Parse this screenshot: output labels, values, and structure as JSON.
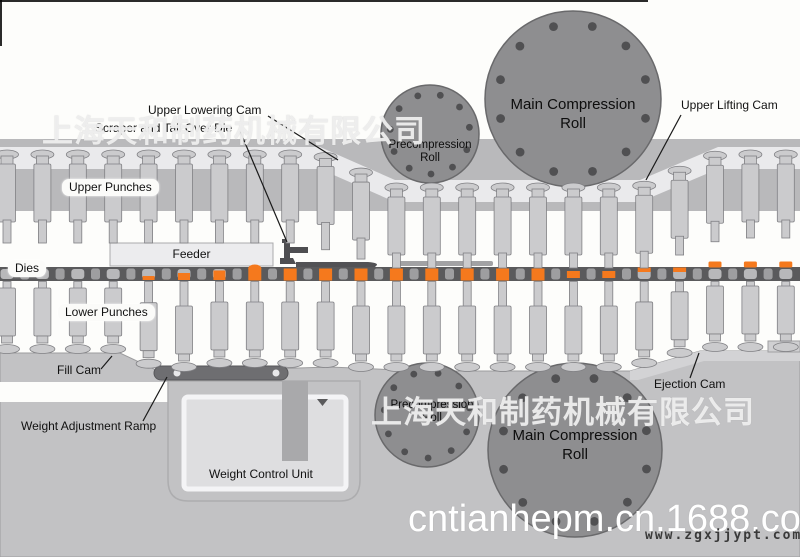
{
  "labels": {
    "upper_lowering_cam": "Upper Lowering Cam",
    "scraper_tail": "Scraper and Tail Over Die",
    "upper_punches": "Upper Punches",
    "feeder": "Feeder",
    "dies": "Dies",
    "lower_punches": "Lower Punches",
    "fill_cam": "Fill Cam",
    "weight_adjustment_ramp": "Weight Adjustment Ramp",
    "weight_control_unit": "Weight Control Unit",
    "ejection_cam": "Ejection Cam",
    "upper_lifting_cam": "Upper Lifting Cam",
    "precompression_roll_top": {
      "line1": "Precompression",
      "line2": "Roll"
    },
    "main_compression_roll_top": {
      "line1": "Main Compression",
      "line2": "Roll"
    },
    "precompression_roll_bottom": {
      "line1": "Precompression",
      "line2": "Roll"
    },
    "main_compression_roll_bottom": {
      "line1": "Main Compression",
      "line2": "Roll"
    }
  },
  "watermarks": {
    "company": "上海天和制药机械有限公司",
    "url_large": "cntianhepm.cn.1688.com",
    "url_small": "www.zgxjjypt.com"
  },
  "colors": {
    "tablet_orange": "#f5791d",
    "die_bar_gray": "#5a5a5c",
    "roll_gray": "#8e8e90",
    "machine_gray": "#c2c2c4",
    "punch_gray": "#cbcbcd",
    "bore_gray": "#b8b8ba"
  }
}
